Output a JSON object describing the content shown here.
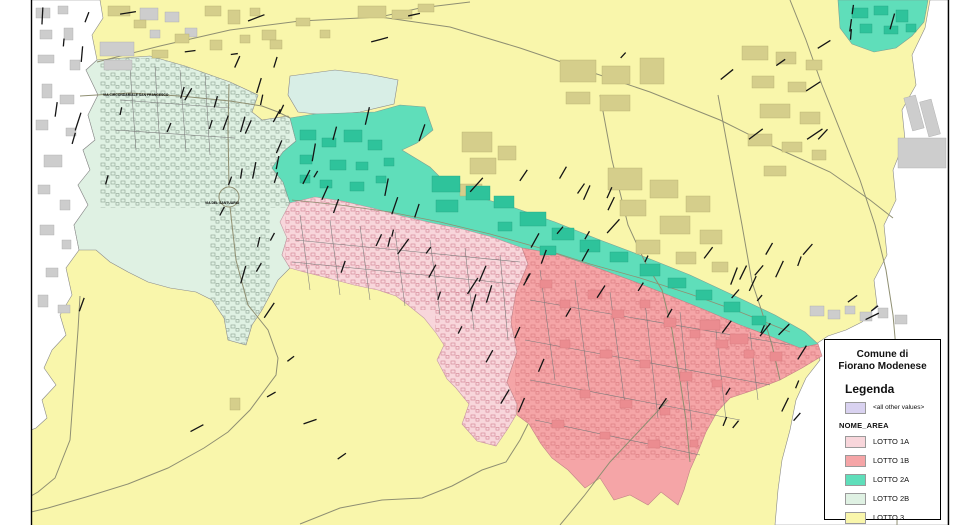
{
  "window": {
    "background": "#FFFFFF"
  },
  "map": {
    "frame_color": "#000000",
    "colors": {
      "outside": "#FFFFFF",
      "lotto3": "#F9F6AB",
      "lotto2b": "#DFF1E3",
      "lotto2b_alt": "#D8EEE6",
      "lotto2a": "#5FDEBA",
      "lotto1a": "#F8D6DB",
      "lotto1b": "#F5A5A7",
      "building_gray": "#CDCDCD",
      "building_khaki": "#D5CE8B",
      "building_teal": "#2EC39B",
      "building_red": "#EB8C90",
      "road": "#8F8F72",
      "street_line": "#7A7A7A",
      "label_mark": "#141414"
    },
    "street_labels": [
      {
        "text": "VIA CIRCONDARIALE SAN FRANCESCO"
      },
      {
        "text": "VIA DEL SANTUARIO"
      }
    ]
  },
  "legend": {
    "title_line1": "Comune di",
    "title_line2": "Fiorano Modenese",
    "heading": "Legenda",
    "other_values": {
      "label": "<all other values>",
      "color": "#D9D2F0"
    },
    "field_name": "NOME_AREA",
    "items": [
      {
        "label": "LOTTO 1A",
        "color": "#F8D6DB"
      },
      {
        "label": "LOTTO 1B",
        "color": "#F5A5A7"
      },
      {
        "label": "LOTTO 2A",
        "color": "#5FDEBA"
      },
      {
        "label": "LOTTO 2B",
        "color": "#DFF1E3"
      },
      {
        "label": "LOTTO 3",
        "color": "#F9F6AB"
      }
    ]
  }
}
